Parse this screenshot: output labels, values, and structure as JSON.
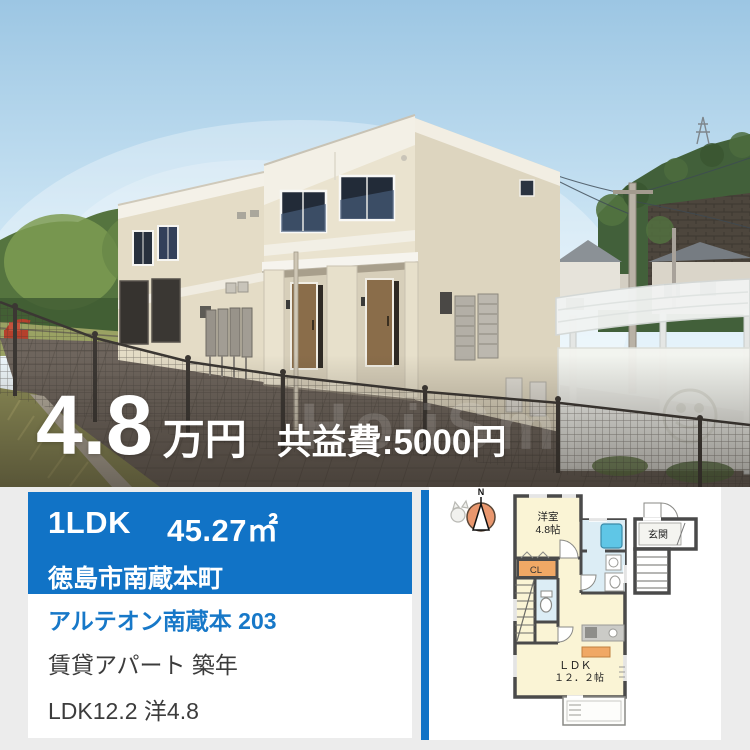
{
  "photo": {
    "price_value": "4.8",
    "price_unit": "万円",
    "fee_text": "共益費:5000円",
    "watermark": "HoüSm"
  },
  "card": {
    "layout": "1LDK",
    "area": "45.27㎡",
    "address": "徳島市南蔵本町",
    "property_name": "アルテオン南蔵本 203",
    "property_type": "賃貸アパート 築年",
    "rooms": "LDK12.2 洋4.8"
  },
  "floorplan": {
    "compass_label": "N",
    "room1_name": "洋室",
    "room1_size": "4.8帖",
    "closet_label": "CL",
    "ldk_label": "ＬＤＫ",
    "ldk_size": "１２．２帖",
    "entrance_label": "玄関"
  },
  "colors": {
    "banner_blue": "#1173c6",
    "link_blue": "#1778c8",
    "page_bg": "#ececec",
    "plan_wall": "#4a4a4a",
    "plan_room": "#faf4d5",
    "plan_wet": "#dcedf5",
    "plan_tub": "#5fc6e6",
    "plan_closet": "#f0a865",
    "compass_orange": "#e9976e"
  }
}
